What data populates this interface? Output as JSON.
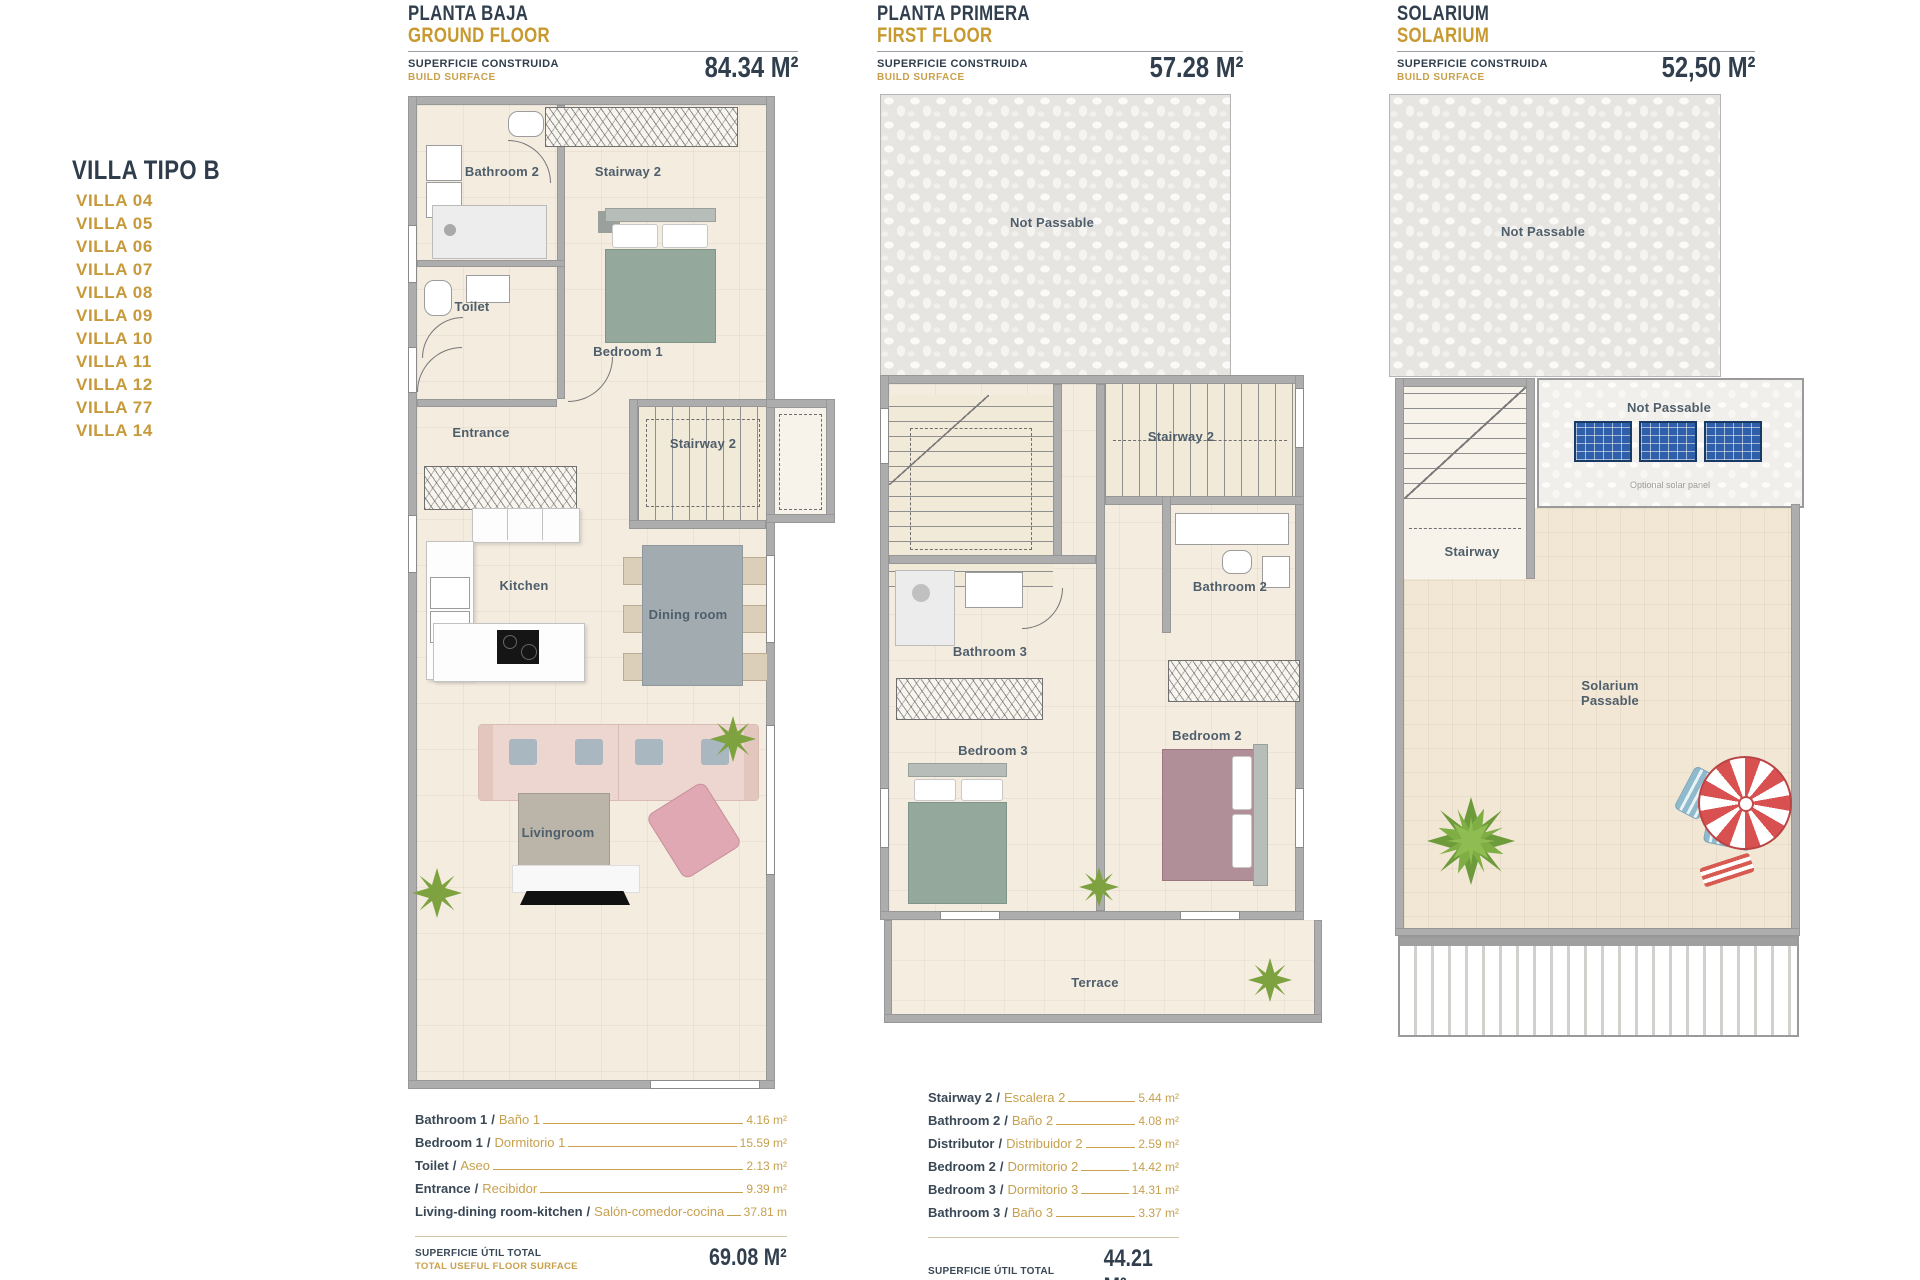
{
  "sidebar": {
    "title": "VILLA TIPO B",
    "villas": [
      "VILLA 04",
      "VILLA 05",
      "VILLA 06",
      "VILLA 07",
      "VILLA 08",
      "VILLA 09",
      "VILLA 10",
      "VILLA 11",
      "VILLA 12",
      "VILLA 77",
      "VILLA 14"
    ]
  },
  "ui": {
    "slash": "/"
  },
  "plans": {
    "ground": {
      "title_es": "PLANTA BAJA",
      "title_en": "GROUND FLOOR",
      "surface_es": "SUPERFICIE CONSTRUIDA",
      "surface_en": "BUILD SURFACE",
      "area": "84.34 M²",
      "labels": {
        "bathroom2": "Bathroom 2",
        "stairway2_top": "Stairway 2",
        "toilet": "Toilet",
        "bedroom1": "Bedroom 1",
        "entrance": "Entrance",
        "stairway2": "Stairway 2",
        "kitchen": "Kitchen",
        "dining": "Dining room",
        "living": "Livingroom"
      }
    },
    "first": {
      "title_es": "PLANTA PRIMERA",
      "title_en": "FIRST FLOOR",
      "surface_es": "SUPERFICIE CONSTRUIDA",
      "surface_en": "BUILD SURFACE",
      "area": "57.28 M²",
      "labels": {
        "not_passable": "Not Passable",
        "stairway2": "Stairway 2",
        "bathroom3": "Bathroom 3",
        "bathroom2": "Bathroom 2",
        "bedroom3": "Bedroom 3",
        "bedroom2": "Bedroom 2",
        "terrace": "Terrace"
      }
    },
    "solarium": {
      "title_es": "SOLARIUM",
      "title_en": "SOLARIUM",
      "surface_es": "SUPERFICIE CONSTRUIDA",
      "surface_en": "BUILD SURFACE",
      "area": "52,50 M²",
      "labels": {
        "not_passable_top": "Not Passable",
        "not_passable_panels": "Not Passable",
        "optional_solar": "Optional solar panel",
        "stairway": "Stairway",
        "solarium1": "Solarium",
        "solarium2": "Passable"
      }
    }
  },
  "tables": {
    "ground": {
      "rows": [
        {
          "en": "Bathroom 1",
          "es": "Baño 1",
          "value": "4.16 m²"
        },
        {
          "en": "Bedroom 1",
          "es": "Dormitorio 1",
          "value": "15.59 m²"
        },
        {
          "en": "Toilet",
          "es": "Aseo",
          "value": "2.13 m²"
        },
        {
          "en": "Entrance",
          "es": "Recibidor",
          "value": "9.39 m²"
        },
        {
          "en": "Living-dining room-kitchen",
          "es": "Salón-comedor-cocina",
          "value": "37.81 m"
        }
      ],
      "total_es": "SUPERFICIE ÚTIL TOTAL",
      "total_en": "TOTAL USEFUL FLOOR SURFACE",
      "total": "69.08 M²"
    },
    "first": {
      "rows": [
        {
          "en": "Stairway 2",
          "es": "Escalera 2",
          "value": "5.44 m²"
        },
        {
          "en": "Bathroom 2",
          "es": "Baño 2",
          "value": "4.08 m²"
        },
        {
          "en": "Distributor",
          "es": "Distribuidor 2",
          "value": "2.59 m²"
        },
        {
          "en": "Bedroom 2",
          "es": "Dormitorio 2",
          "value": "14.42 m²"
        },
        {
          "en": "Bedroom 3",
          "es": "Dormitorio 3",
          "value": "14.31 m²"
        },
        {
          "en": "Bathroom 3",
          "es": "Baño 3",
          "value": "3.37 m²"
        }
      ],
      "total_es": "SUPERFICIE ÚTIL TOTAL",
      "total_en": "TOTAL USEFUL FLOOR SURFACE",
      "total": "44.21 M²"
    }
  }
}
